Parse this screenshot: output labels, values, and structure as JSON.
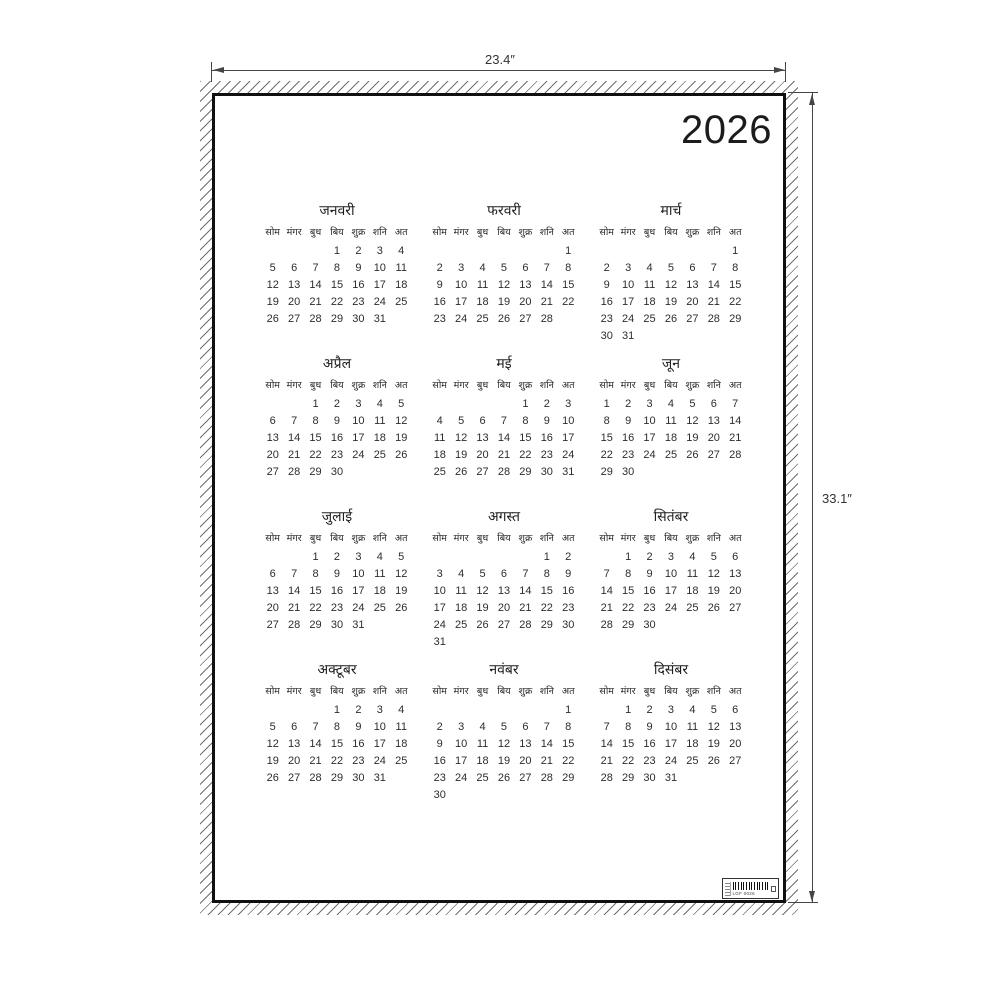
{
  "mockup": {
    "width_label": "23.4″",
    "height_label": "33.1″"
  },
  "poster": {
    "year": "2026",
    "weekday_headers": [
      "सोम",
      "मंगर",
      "बुध",
      "बिय",
      "शुक्र",
      "शनि",
      "अत"
    ],
    "months": [
      {
        "name": "जनवरी",
        "weeks": [
          [
            "",
            "",
            "",
            "1",
            "2",
            "3",
            "4"
          ],
          [
            "5",
            "6",
            "7",
            "8",
            "9",
            "10",
            "11"
          ],
          [
            "12",
            "13",
            "14",
            "15",
            "16",
            "17",
            "18"
          ],
          [
            "19",
            "20",
            "21",
            "22",
            "23",
            "24",
            "25"
          ],
          [
            "26",
            "27",
            "28",
            "29",
            "30",
            "31",
            ""
          ]
        ]
      },
      {
        "name": "फरवरी",
        "weeks": [
          [
            "",
            "",
            "",
            "",
            "",
            "",
            "1"
          ],
          [
            "2",
            "3",
            "4",
            "5",
            "6",
            "7",
            "8"
          ],
          [
            "9",
            "10",
            "11",
            "12",
            "13",
            "14",
            "15"
          ],
          [
            "16",
            "17",
            "18",
            "19",
            "20",
            "21",
            "22"
          ],
          [
            "23",
            "24",
            "25",
            "26",
            "27",
            "28",
            ""
          ]
        ]
      },
      {
        "name": "मार्च",
        "weeks": [
          [
            "",
            "",
            "",
            "",
            "",
            "",
            "1"
          ],
          [
            "2",
            "3",
            "4",
            "5",
            "6",
            "7",
            "8"
          ],
          [
            "9",
            "10",
            "11",
            "12",
            "13",
            "14",
            "15"
          ],
          [
            "16",
            "17",
            "18",
            "19",
            "20",
            "21",
            "22"
          ],
          [
            "23",
            "24",
            "25",
            "26",
            "27",
            "28",
            "29"
          ],
          [
            "30",
            "31",
            "",
            "",
            "",
            "",
            ""
          ]
        ]
      },
      {
        "name": "अप्रैल",
        "weeks": [
          [
            "",
            "",
            "1",
            "2",
            "3",
            "4",
            "5"
          ],
          [
            "6",
            "7",
            "8",
            "9",
            "10",
            "11",
            "12"
          ],
          [
            "13",
            "14",
            "15",
            "16",
            "17",
            "18",
            "19"
          ],
          [
            "20",
            "21",
            "22",
            "23",
            "24",
            "25",
            "26"
          ],
          [
            "27",
            "28",
            "29",
            "30",
            "",
            "",
            ""
          ]
        ]
      },
      {
        "name": "मई",
        "weeks": [
          [
            "",
            "",
            "",
            "",
            "1",
            "2",
            "3"
          ],
          [
            "4",
            "5",
            "6",
            "7",
            "8",
            "9",
            "10"
          ],
          [
            "11",
            "12",
            "13",
            "14",
            "15",
            "16",
            "17"
          ],
          [
            "18",
            "19",
            "20",
            "21",
            "22",
            "23",
            "24"
          ],
          [
            "25",
            "26",
            "27",
            "28",
            "29",
            "30",
            "31"
          ]
        ]
      },
      {
        "name": "जून",
        "weeks": [
          [
            "1",
            "2",
            "3",
            "4",
            "5",
            "6",
            "7"
          ],
          [
            "8",
            "9",
            "10",
            "11",
            "12",
            "13",
            "14"
          ],
          [
            "15",
            "16",
            "17",
            "18",
            "19",
            "20",
            "21"
          ],
          [
            "22",
            "23",
            "24",
            "25",
            "26",
            "27",
            "28"
          ],
          [
            "29",
            "30",
            "",
            "",
            "",
            "",
            ""
          ]
        ]
      },
      {
        "name": "जुलाई",
        "weeks": [
          [
            "",
            "",
            "1",
            "2",
            "3",
            "4",
            "5"
          ],
          [
            "6",
            "7",
            "8",
            "9",
            "10",
            "11",
            "12"
          ],
          [
            "13",
            "14",
            "15",
            "16",
            "17",
            "18",
            "19"
          ],
          [
            "20",
            "21",
            "22",
            "23",
            "24",
            "25",
            "26"
          ],
          [
            "27",
            "28",
            "29",
            "30",
            "31",
            "",
            ""
          ]
        ]
      },
      {
        "name": "अगस्त",
        "weeks": [
          [
            "",
            "",
            "",
            "",
            "",
            "1",
            "2"
          ],
          [
            "3",
            "4",
            "5",
            "6",
            "7",
            "8",
            "9"
          ],
          [
            "10",
            "11",
            "12",
            "13",
            "14",
            "15",
            "16"
          ],
          [
            "17",
            "18",
            "19",
            "20",
            "21",
            "22",
            "23"
          ],
          [
            "24",
            "25",
            "26",
            "27",
            "28",
            "29",
            "30"
          ],
          [
            "31",
            "",
            "",
            "",
            "",
            "",
            ""
          ]
        ]
      },
      {
        "name": "सितंबर",
        "weeks": [
          [
            "",
            "1",
            "2",
            "3",
            "4",
            "5",
            "6"
          ],
          [
            "7",
            "8",
            "9",
            "10",
            "11",
            "12",
            "13"
          ],
          [
            "14",
            "15",
            "16",
            "17",
            "18",
            "19",
            "20"
          ],
          [
            "21",
            "22",
            "23",
            "24",
            "25",
            "26",
            "27"
          ],
          [
            "28",
            "29",
            "30",
            "",
            "",
            "",
            ""
          ]
        ]
      },
      {
        "name": "अक्टूबर",
        "weeks": [
          [
            "",
            "",
            "",
            "1",
            "2",
            "3",
            "4"
          ],
          [
            "5",
            "6",
            "7",
            "8",
            "9",
            "10",
            "11"
          ],
          [
            "12",
            "13",
            "14",
            "15",
            "16",
            "17",
            "18"
          ],
          [
            "19",
            "20",
            "21",
            "22",
            "23",
            "24",
            "25"
          ],
          [
            "26",
            "27",
            "28",
            "29",
            "30",
            "31",
            ""
          ]
        ]
      },
      {
        "name": "नवंबर",
        "weeks": [
          [
            "",
            "",
            "",
            "",
            "",
            "",
            "1"
          ],
          [
            "2",
            "3",
            "4",
            "5",
            "6",
            "7",
            "8"
          ],
          [
            "9",
            "10",
            "11",
            "12",
            "13",
            "14",
            "15"
          ],
          [
            "16",
            "17",
            "18",
            "19",
            "20",
            "21",
            "22"
          ],
          [
            "23",
            "24",
            "25",
            "26",
            "27",
            "28",
            "29"
          ],
          [
            "30",
            "",
            "",
            "",
            "",
            "",
            ""
          ]
        ]
      },
      {
        "name": "दिसंबर",
        "weeks": [
          [
            "",
            "1",
            "2",
            "3",
            "4",
            "5",
            "6"
          ],
          [
            "7",
            "8",
            "9",
            "10",
            "11",
            "12",
            "13"
          ],
          [
            "14",
            "15",
            "16",
            "17",
            "18",
            "19",
            "20"
          ],
          [
            "21",
            "22",
            "23",
            "24",
            "25",
            "26",
            "27"
          ],
          [
            "28",
            "29",
            "30",
            "31",
            "",
            "",
            ""
          ]
        ]
      }
    ],
    "barcode": {
      "code_text": "LGF 0026"
    }
  },
  "colors": {
    "ink": "#1c1c1c",
    "border": "#101010",
    "dimension": "#454545",
    "hatch": "#6f6f6f",
    "background": "#ffffff"
  }
}
